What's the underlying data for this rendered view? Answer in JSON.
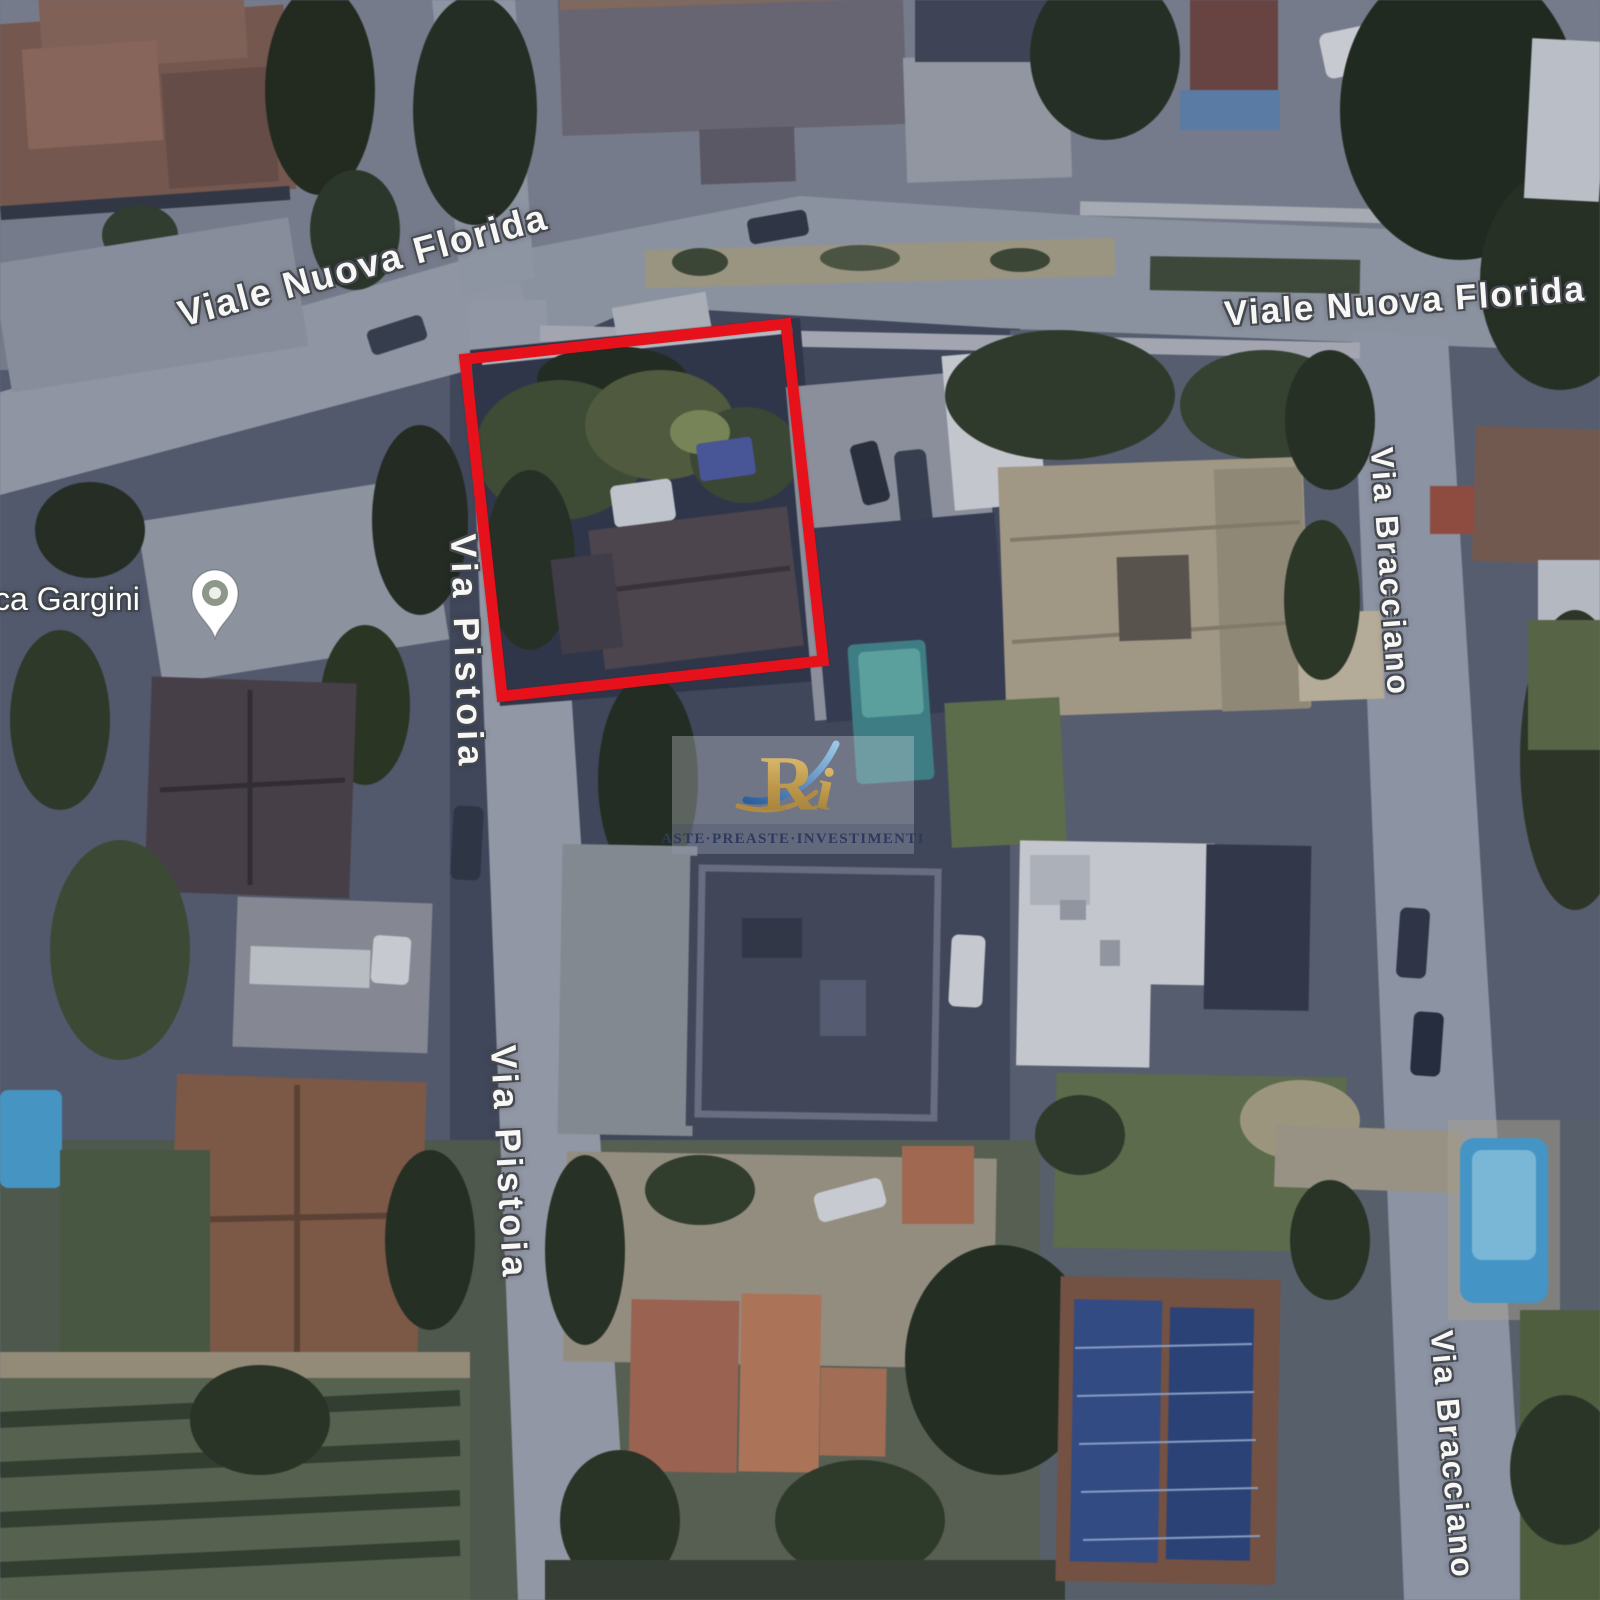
{
  "map": {
    "imagery_type": "satellite",
    "street_labels": {
      "viale_nuova_florida_left": "Viale Nuova Florida",
      "viale_nuova_florida_right": "Viale Nuova Florida",
      "via_pistoia_upper": "Via Pistoia",
      "via_pistoia_lower": "Via Pistoia",
      "via_bracciano_upper": "Via Bracciano",
      "via_bracciano_lower": "Via Bracciano"
    },
    "place_label": "ca Gargini",
    "highlight_color": "#e6111b",
    "pin_color": "#ffffff"
  },
  "watermark": {
    "monogram_r": "R",
    "monogram_i": "i",
    "caption": "ASTE·PREASTE·INVESTIMENTI",
    "gold_color": "#c09a4d",
    "navy_color": "#2d3a5e"
  }
}
